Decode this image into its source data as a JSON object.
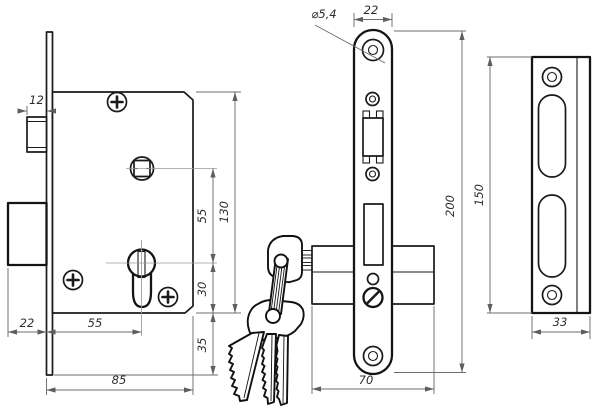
{
  "drawing": {
    "kind": "mortise-lock-technical-drawing",
    "background": "#ffffff",
    "colors": {
      "outline": "#1a1a1a",
      "dimension_lines": "#6d6d6d",
      "centerlines": "#9a9a9a",
      "label_text": "#2d2d2d"
    },
    "dims": {
      "latch_offset": "12",
      "bolt_throw": "22",
      "backset": "55",
      "case_depth": "85",
      "follower_to_cylinder": "55",
      "case_height": "130",
      "cylinder_to_bottom": "30",
      "plate_overhang": "35",
      "hole_diameter": "⌀5,4",
      "face_width": "22",
      "face_length": "200",
      "total_depth": "70",
      "strike_length": "150",
      "strike_width": "33"
    }
  }
}
